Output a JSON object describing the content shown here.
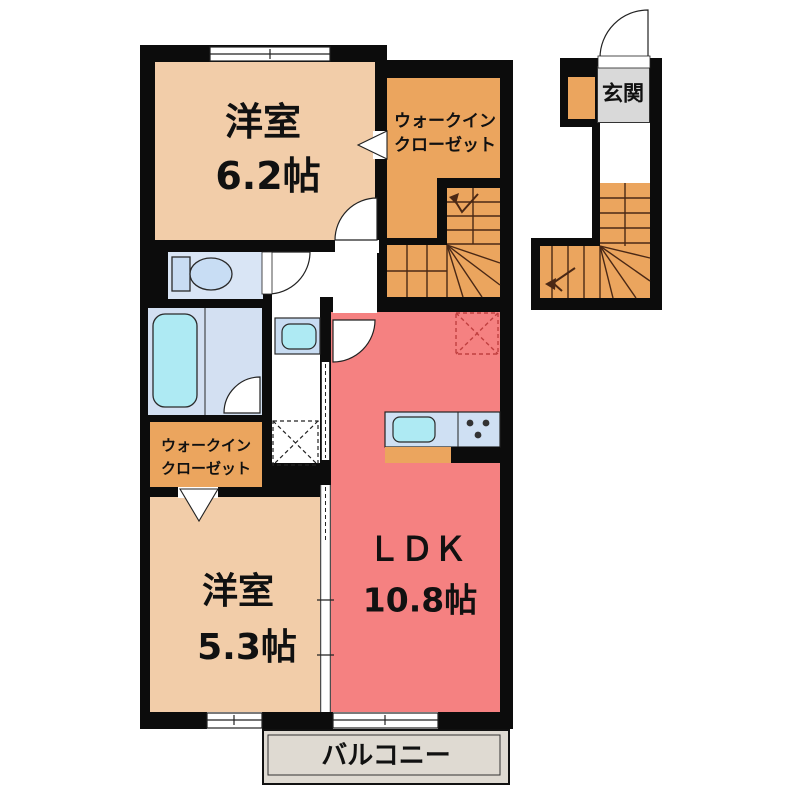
{
  "plan": {
    "type": "apartment-floor-plan",
    "rooms": {
      "bedroom_top": {
        "label": "洋室",
        "area": "6.2帖"
      },
      "wic_top": {
        "label_line1": "ウォークイン",
        "label_line2": "クローゼット"
      },
      "entrance": {
        "label": "玄関"
      },
      "wic_middle": {
        "label_line1": "ウォークイン",
        "label_line2": "クローゼット"
      },
      "bedroom_bottom": {
        "label": "洋室",
        "area": "5.3帖"
      },
      "ldk": {
        "label": "ＬＤＫ",
        "area": "10.8帖"
      },
      "balcony": {
        "label": "バルコニー"
      }
    },
    "fixtures": [
      "toilet",
      "bathtub",
      "washbasin",
      "kitchen-sink",
      "stove",
      "washing-machine-space",
      "refrigerator-space",
      "staircase",
      "entry-staircase",
      "entry-door",
      "shoe-cabinet"
    ],
    "colors": {
      "wall": "#0c0c0c",
      "bedroom_peach": "#f2cda9",
      "closet_orange": "#eba55e",
      "ldk_red": "#f58181",
      "bath_blue": "#d9e5f5",
      "fixture_cyan": "#aeeaf3",
      "fixture_blue": "#c8dcf2",
      "entrance_gray": "#d9d9d9",
      "balcony_gray": "#dfdad2",
      "stair_lines": "#4a2815",
      "fridge_dash": "#c04040"
    }
  }
}
